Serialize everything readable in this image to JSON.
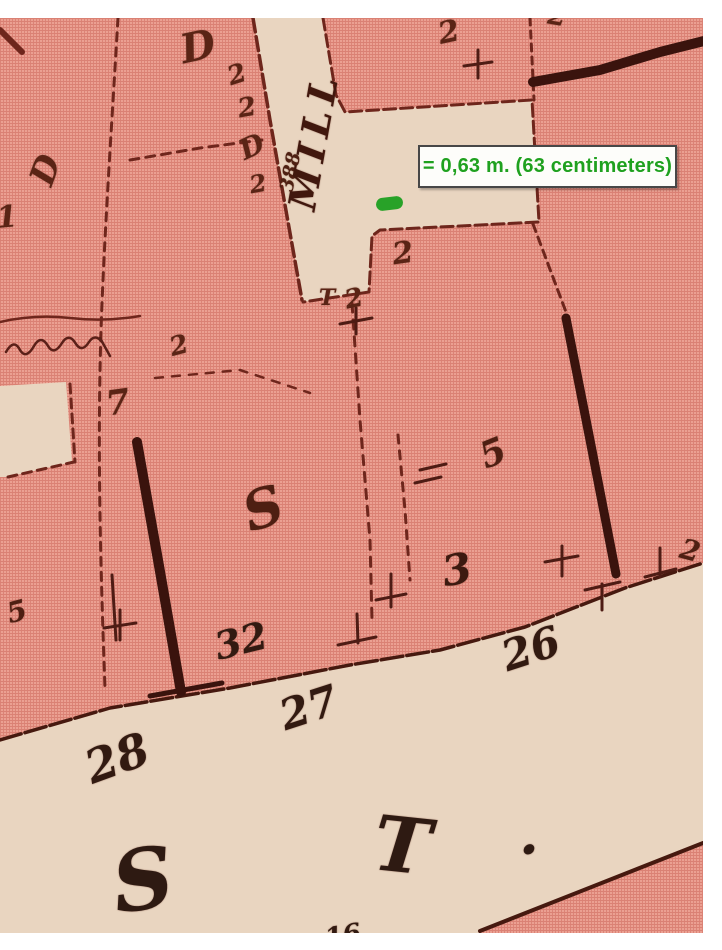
{
  "annotation": {
    "text": "= 0,63 m. (63 centimeters)",
    "text_color": "#1fa11f",
    "box_background": "#fdfdfa",
    "box_border": "#474747"
  },
  "marker": {
    "color": "#28a228"
  },
  "map": {
    "colors": {
      "block_pink": "#eba092",
      "street_beige": "#e9d5c0",
      "ink": "#5a2015",
      "heavy_ink": "#3a130d",
      "margin_white": "#ffffff"
    },
    "street_names": [
      "MILL",
      "S T."
    ],
    "lot_numbers": [
      "28",
      "27",
      "26",
      "32",
      "16",
      "388"
    ],
    "labels": [
      {
        "text": "D",
        "x": 198,
        "y": 47,
        "size": 40,
        "rot": -12,
        "c": "#5a2415"
      },
      {
        "text": "2",
        "x": 237,
        "y": 75,
        "size": 26,
        "rot": -18,
        "c": "#5a2415"
      },
      {
        "text": "2",
        "x": 247,
        "y": 108,
        "size": 26,
        "rot": -10,
        "c": "#5a2415"
      },
      {
        "text": "D",
        "x": 252,
        "y": 147,
        "size": 28,
        "rot": -25,
        "c": "#5a2415"
      },
      {
        "text": "2",
        "x": 258,
        "y": 184,
        "size": 24,
        "rot": -10,
        "c": "#5a2415"
      },
      {
        "text": "388",
        "x": 291,
        "y": 172,
        "size": 19,
        "rot": -78,
        "c": "#4e2012"
      },
      {
        "text": "MILL",
        "x": 314,
        "y": 140,
        "size": 38,
        "rot": -80,
        "spacing": 7,
        "c": "#41180e"
      },
      {
        "text": "D",
        "x": 46,
        "y": 170,
        "size": 34,
        "rot": -70,
        "c": "#5a2415"
      },
      {
        "text": "1",
        "x": 7,
        "y": 218,
        "size": 30,
        "rot": -5,
        "c": "#5a2415"
      },
      {
        "text": "2",
        "x": 449,
        "y": 33,
        "size": 30,
        "rot": -12,
        "c": "#5a2415"
      },
      {
        "text": "2",
        "x": 557,
        "y": 17,
        "size": 26,
        "rot": 10,
        "c": "#5a2415"
      },
      {
        "text": "2",
        "x": 403,
        "y": 254,
        "size": 30,
        "rot": -8,
        "c": "#5a2415"
      },
      {
        "text": "T",
        "x": 327,
        "y": 298,
        "size": 22,
        "rot": 0,
        "c": "#5a2415"
      },
      {
        "text": "2",
        "x": 354,
        "y": 299,
        "size": 26,
        "rot": -12,
        "c": "#5a2415"
      },
      {
        "text": "2",
        "x": 179,
        "y": 346,
        "size": 26,
        "rot": -15,
        "c": "#5a2415"
      },
      {
        "text": "7",
        "x": 118,
        "y": 403,
        "size": 34,
        "rot": -8,
        "c": "#5a2415"
      },
      {
        "text": "S",
        "x": 263,
        "y": 508,
        "size": 54,
        "rot": -18,
        "c": "#4e1f12"
      },
      {
        "text": "5",
        "x": 493,
        "y": 453,
        "size": 36,
        "rot": -22,
        "c": "#4e1f12"
      },
      {
        "text": "3",
        "x": 457,
        "y": 570,
        "size": 42,
        "rot": -10,
        "c": "#3c1a10"
      },
      {
        "text": "2",
        "x": 690,
        "y": 551,
        "size": 28,
        "rot": 15,
        "c": "#4e1f12"
      },
      {
        "text": "5",
        "x": 17,
        "y": 612,
        "size": 28,
        "rot": -15,
        "c": "#4e1f12"
      },
      {
        "text": "32",
        "x": 241,
        "y": 641,
        "size": 38,
        "rot": -14,
        "c": "#321a11"
      },
      {
        "text": "27",
        "x": 309,
        "y": 708,
        "size": 42,
        "rot": -18,
        "c": "#321a11"
      },
      {
        "text": "26",
        "x": 531,
        "y": 649,
        "size": 42,
        "rot": -18,
        "c": "#321a11"
      },
      {
        "text": "28",
        "x": 117,
        "y": 758,
        "size": 46,
        "rot": -20,
        "c": "#321a11"
      },
      {
        "text": "S",
        "x": 143,
        "y": 880,
        "size": 84,
        "rot": -8,
        "c": "#2e1a12"
      },
      {
        "text": "T",
        "x": 402,
        "y": 846,
        "size": 76,
        "rot": 6,
        "c": "#2e1a12"
      },
      {
        "text": "·",
        "x": 529,
        "y": 850,
        "size": 56,
        "rot": 0,
        "c": "#2e1a12"
      },
      {
        "text": "16",
        "x": 343,
        "y": 936,
        "size": 26,
        "rot": -10,
        "c": "#321a11"
      }
    ]
  }
}
